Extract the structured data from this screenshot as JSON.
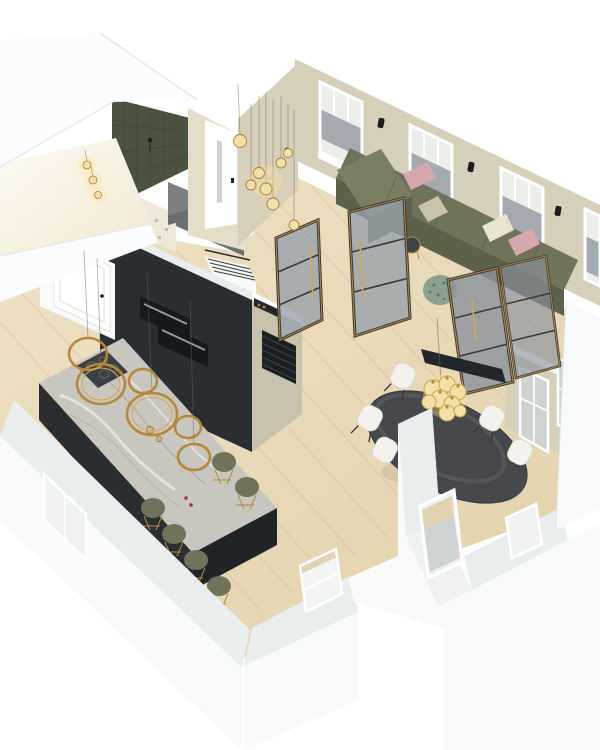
{
  "meta": {
    "description": "3D isometric cutaway render of an apartment floor plan with open-plan kitchen, living room, dining area, entry hall, stairs and bathroom",
    "view": {
      "width": 600,
      "height": 750
    }
  },
  "scene": {
    "rooms": [
      {
        "label": "living room"
      },
      {
        "label": "kitchen"
      },
      {
        "label": "dining area"
      },
      {
        "label": "entry hall"
      },
      {
        "label": "bathroom"
      },
      {
        "label": "staircase"
      }
    ],
    "furniture": [
      "olive corner sofa with pink and cream cushions",
      "speckled green pouf",
      "round side table",
      "steel-framed glass swing doors",
      "glass partition panels",
      "wall-mounted dark console",
      "dark oval dining table",
      "white dining chairs",
      "glass bubble chandelier",
      "kitchen island with marble countertop and induction hob",
      "olive bar stools with brass wire legs",
      "brass ring pendant lights",
      "dark tall kitchen wall with built-in ovens",
      "wine shelf and slatted rack",
      "white entry door",
      "white interior door",
      "gray bench",
      "green mosaic tile wall",
      "glass pendant light cluster",
      "roller blinds",
      "black wall sconces"
    ]
  },
  "colors": {
    "bg": "#ffffff",
    "slab": "#fbfcfd",
    "slab_edge": "#e2e7e9",
    "wall_top": "#e9edee",
    "wall_face": "#f8fafa",
    "wall_shadow": "#dfe4e6",
    "beige": "#d6d0ba",
    "beige_light": "#e4dec9",
    "beige_dark": "#c8c2ac",
    "cap_white": "#ffffff",
    "floor_a": "#efe1c5",
    "floor_b": "#e2d1ab",
    "floor_line": "#d2bd97",
    "hall_floor": "#6e7073",
    "tile_green": "#4b5340",
    "tile_line": "#384030",
    "mosaic": "#efe8d8",
    "bench": "#7e807f",
    "stair_white": "#f4f5f5",
    "stair_line": "#3a3d40",
    "kitchen_dark": "#2a2e33",
    "oven_dark": "#17191c",
    "oven_handle": "#9299a0",
    "island_side": "#2b2e30",
    "island_end": "#212427",
    "marble": "#c9c5bf",
    "marble_vein_light": "#ebe8e3",
    "marble_vein_dark": "#a19c95",
    "cooktop": "#3b3f43",
    "brass": "#b5893c",
    "brass_light": "#d3a856",
    "sofa_top": "#70735a",
    "sofa_front": "#5e614a",
    "sofa_light": "#7b7e63",
    "pillow_pink": "#d5a8ad",
    "pillow_cream": "#e9e3d1",
    "pouf": "#8ba08e",
    "pouf_dot": "#5e7a64",
    "glass": "#99a1ab",
    "glass_dark": "#8b929d",
    "frame_dark": "#393a3c",
    "table": "#46484c",
    "table_dark": "#35373b",
    "chair": "#f3f2ed",
    "chair_edge": "#d9d7cf",
    "chair_leg": "#3a332b",
    "blind": "#a4aab0",
    "window_sky": "#eceeea",
    "white": "#ffffff",
    "sconce": "#1c1d1e",
    "console": "#23272b",
    "shelf_dark": "#26282a",
    "rack_dark": "#1d2022",
    "light_warm": "#f3dfa8",
    "light_glow": "rgba(255,225,150,0.35)",
    "wood_hint": "#e0d2b2",
    "gray_glass": "#ced3d1",
    "candle_red": "#b03434",
    "wire": "rgba(110,100,85,0.55)",
    "seam": "rgba(0,0,0,0.16)"
  }
}
